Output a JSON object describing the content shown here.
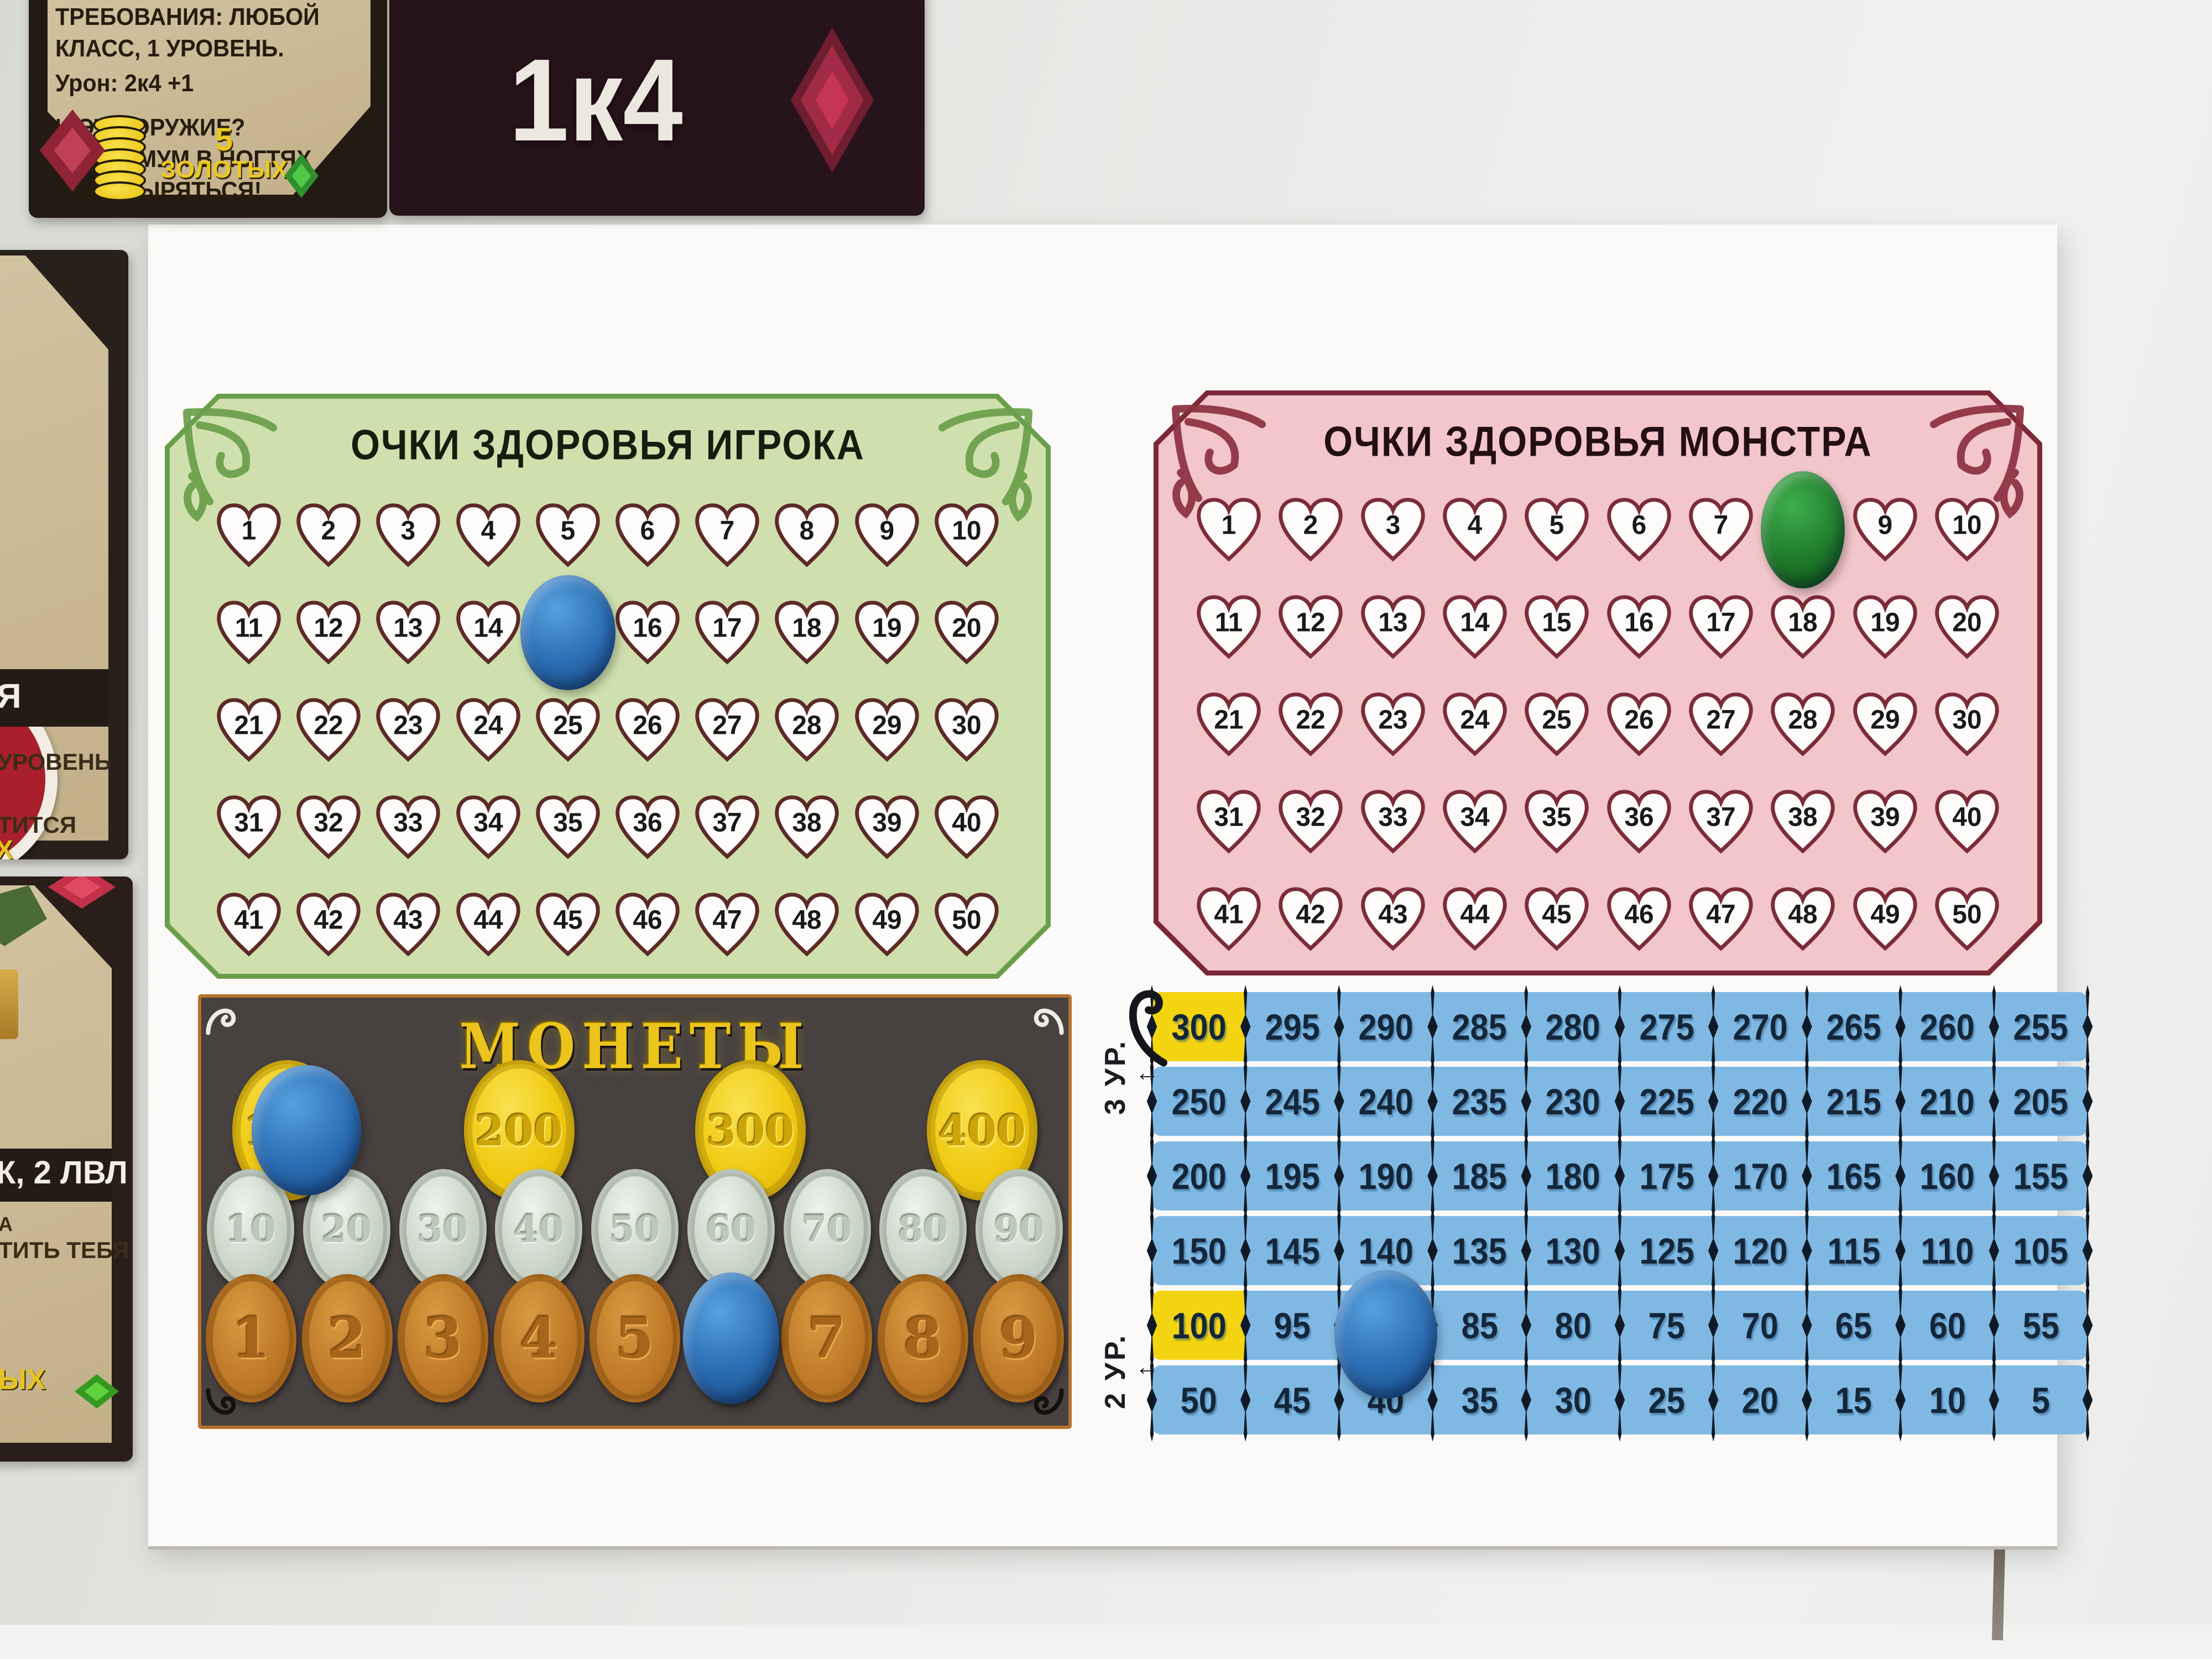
{
  "player_health": {
    "title": "ОЧКИ ЗДОРОВЬЯ ИГРОКА",
    "values": [
      1,
      2,
      3,
      4,
      5,
      6,
      7,
      8,
      9,
      10,
      11,
      12,
      13,
      14,
      15,
      16,
      17,
      18,
      19,
      20,
      21,
      22,
      23,
      24,
      25,
      26,
      27,
      28,
      29,
      30,
      31,
      32,
      33,
      34,
      35,
      36,
      37,
      38,
      39,
      40,
      41,
      42,
      43,
      44,
      45,
      46,
      47,
      48,
      49,
      50
    ],
    "token": {
      "color": "blue",
      "on_value": 15
    }
  },
  "monster_health": {
    "title": "ОЧКИ ЗДОРОВЬЯ МОНСТРА",
    "values": [
      1,
      2,
      3,
      4,
      5,
      6,
      7,
      8,
      9,
      10,
      11,
      12,
      13,
      14,
      15,
      16,
      17,
      18,
      19,
      20,
      21,
      22,
      23,
      24,
      25,
      26,
      27,
      28,
      29,
      30,
      31,
      32,
      33,
      34,
      35,
      36,
      37,
      38,
      39,
      40,
      41,
      42,
      43,
      44,
      45,
      46,
      47,
      48,
      49,
      50
    ],
    "token": {
      "color": "green",
      "on_value": 8
    }
  },
  "coins": {
    "title": "МОНЕТЫ",
    "gold": [
      100,
      200,
      300,
      400
    ],
    "silver": [
      10,
      20,
      30,
      40,
      50,
      60,
      70,
      80,
      90
    ],
    "copper": [
      1,
      2,
      3,
      4,
      5,
      6,
      7,
      8,
      9
    ],
    "tokens": [
      {
        "color": "blue",
        "on_value": 100
      },
      {
        "color": "blue",
        "on_value": 6
      }
    ]
  },
  "track": {
    "rows": [
      [
        300,
        295,
        290,
        285,
        280,
        275,
        270,
        265,
        260,
        255
      ],
      [
        250,
        245,
        240,
        235,
        230,
        225,
        220,
        215,
        210,
        205
      ],
      [
        200,
        195,
        190,
        185,
        180,
        175,
        170,
        165,
        160,
        155
      ],
      [
        150,
        145,
        140,
        135,
        130,
        125,
        120,
        115,
        110,
        105
      ],
      [
        100,
        95,
        90,
        85,
        80,
        75,
        70,
        65,
        60,
        55
      ],
      [
        50,
        45,
        40,
        35,
        30,
        25,
        20,
        15,
        10,
        5
      ]
    ],
    "highlighted_values": [
      300,
      100
    ],
    "labels": [
      {
        "text": "3 УР.",
        "arrow": "↕"
      },
      {
        "text": "2 УР.",
        "arrow": "↕"
      }
    ],
    "token": {
      "color": "blue",
      "on_value": 90
    }
  },
  "cards": {
    "weapon_card": {
      "line1": "ТРЕБОВАНИЯ: ЛЮБОЙ КЛАСС, 1 УРОВЕНЬ.",
      "line2": "Урон: 2к4 +1",
      "line3": "И ЭТО ОРУЖИЕ? МАКСИМУМ В НОГТЯХ",
      "line4": "ПОКОВЫРЯТЬСЯ!",
      "cost_value": "5",
      "cost_label": "ЗОЛОТЫХ"
    },
    "dice_card": {
      "value": "1к4"
    },
    "left_card_top": {
      "fragments": [
        "Я",
        "УРОВЕНЬ",
        "ТИТСЯ",
        "Х"
      ]
    },
    "left_card_bottom": {
      "fragments": [
        "К, 2 ЛВЛ",
        "А",
        "ТИТЬ ТЕБЯ",
        "ЫХ"
      ]
    }
  },
  "colors": {
    "blue_token": "#2a6cb2",
    "green_token": "#1f7a2a",
    "track_blue": "#7fb9e3",
    "track_highlight_yellow": "#f2d411",
    "player_panel_green": "#cfe0ae",
    "monster_panel_pink": "#f2c6cb",
    "heart_outline_green_panel": "#5d2a28",
    "heart_outline_pink_panel": "#7c2c38",
    "gold_coin": "#f0ca12",
    "silver_coin": "#ccd5ca",
    "copper_coin": "#c07a28",
    "coins_panel_bg": "#474140",
    "coins_title_gold": "#edc41c"
  }
}
